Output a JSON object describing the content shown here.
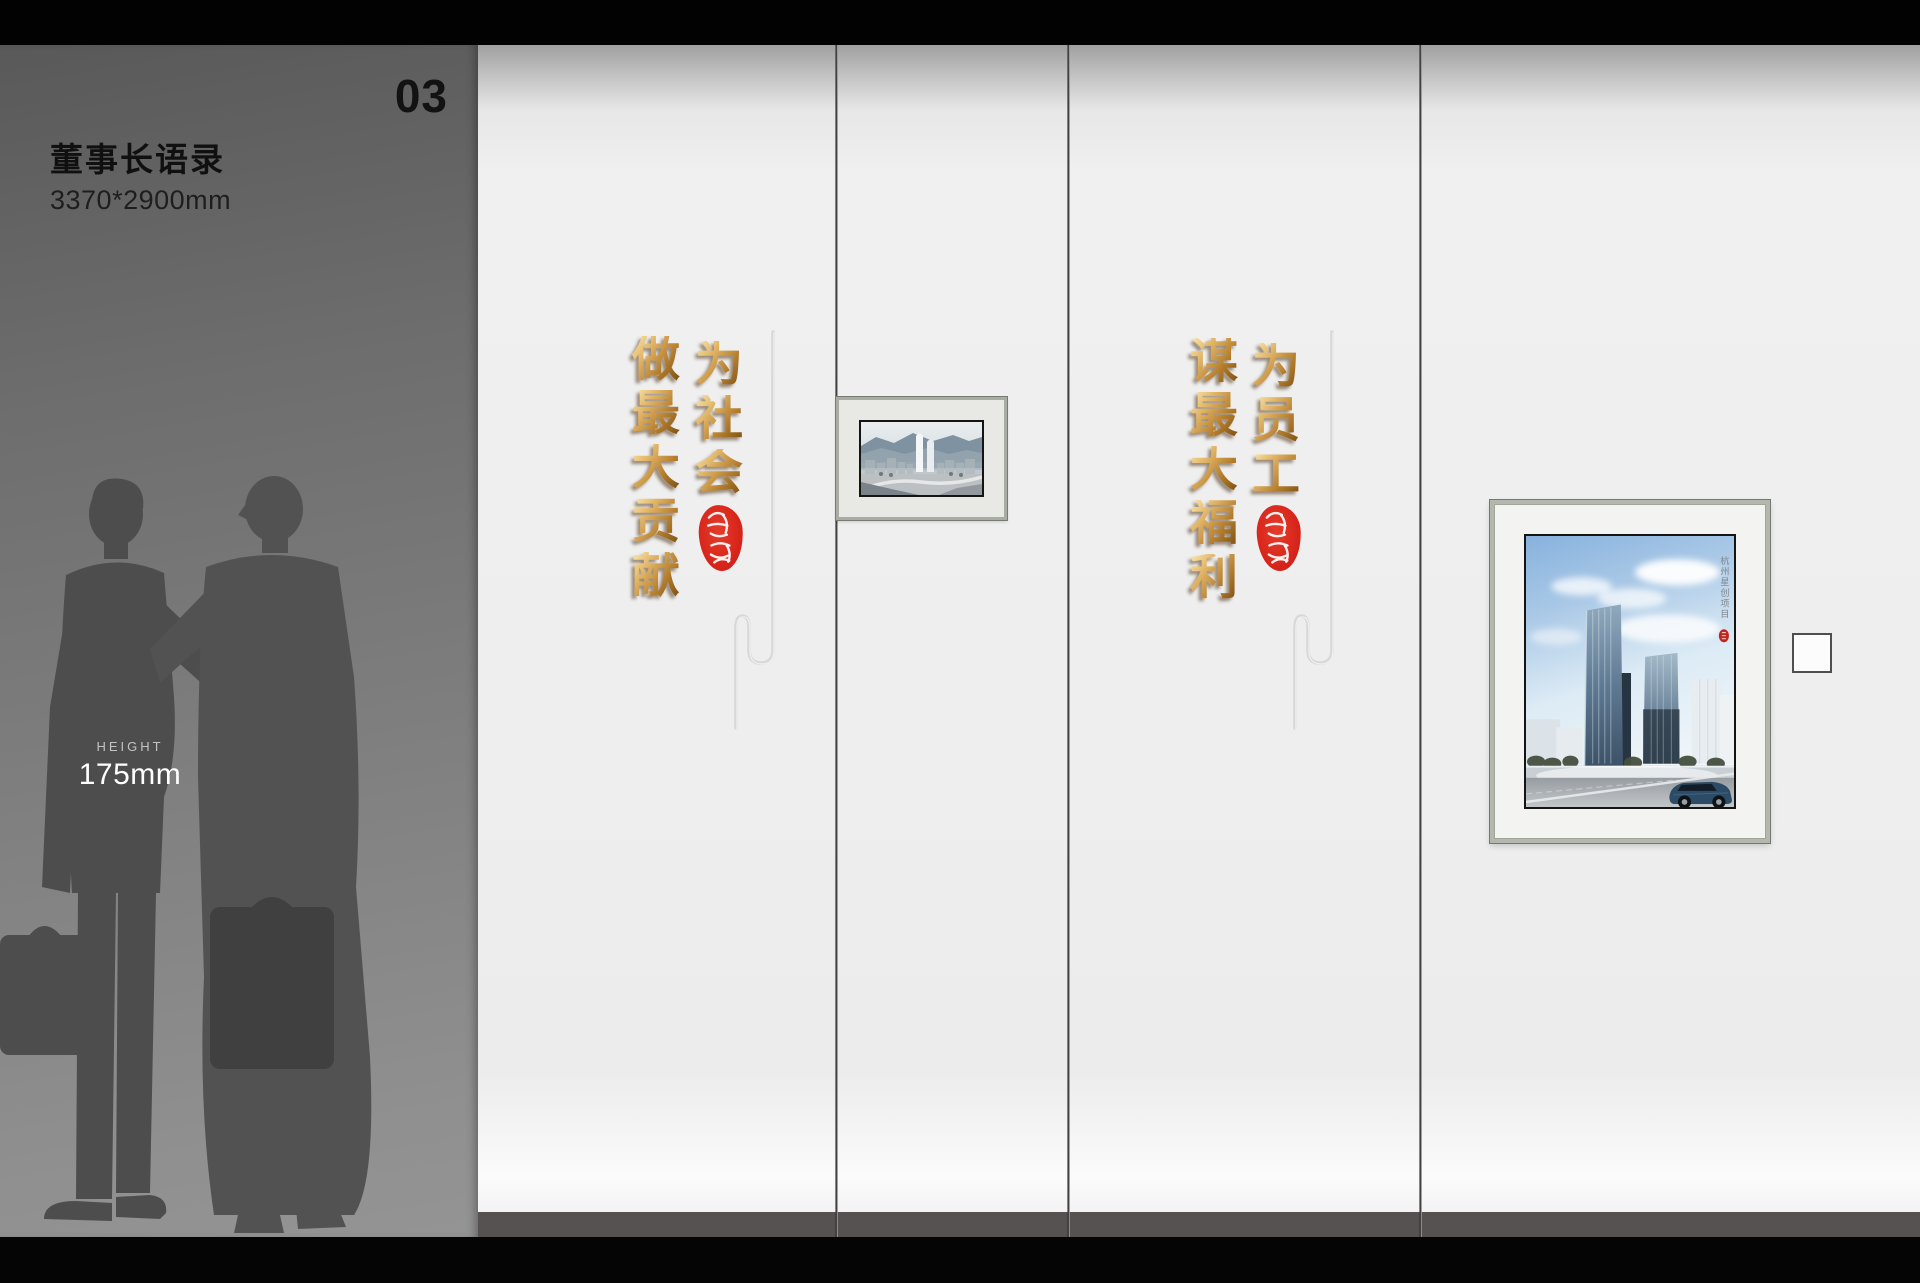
{
  "sheet": {
    "index_number": "03"
  },
  "info_panel": {
    "title": "董事长语录",
    "size_label": "3370*2900mm",
    "height_caption": "HEIGHT",
    "height_value": "175mm"
  },
  "quotes": {
    "left": {
      "phrase": "为社会做最大贡献",
      "column_right": "为社会",
      "column_left": "做最大贡献"
    },
    "right": {
      "phrase": "为员工谋最大福利",
      "column_right": "为员工",
      "column_left": "谋最大福利"
    }
  },
  "frames": {
    "large_caption": "杭州星创项目"
  },
  "colors": {
    "gold_light": "#f6dc9c",
    "gold_mid": "#b67f2e",
    "gold_dark": "#7d5014",
    "seal_red": "#d8251b",
    "skirting": "#575252",
    "wall_light": "#efefef",
    "panel_gray": "#7a7a7a"
  }
}
